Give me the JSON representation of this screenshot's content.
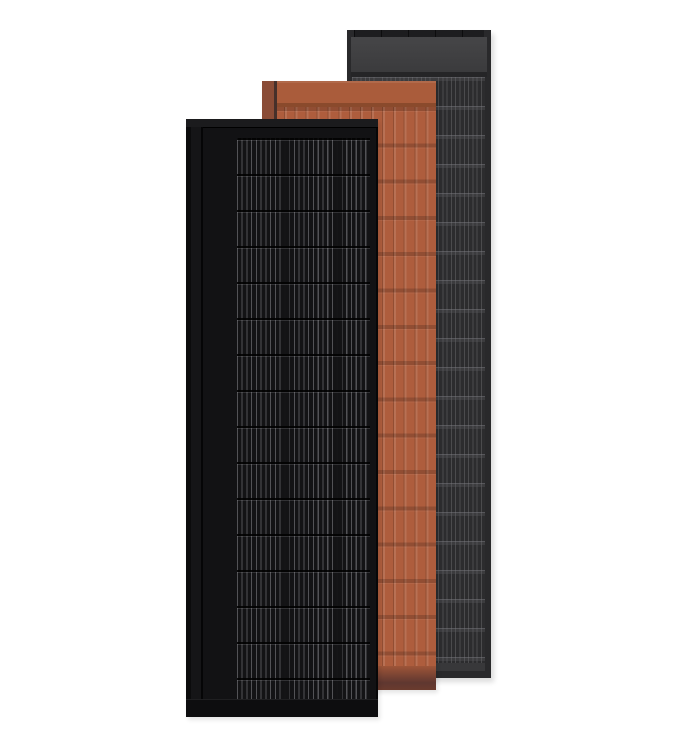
{
  "scene": {
    "description": "Product render of three overlapping rectangular solar roof panels standing upright on a plain white background: a black full-black module in front, a terracotta tile-look module in the middle, and an anthracite dark-gray module at the back.",
    "panel_count": 3
  },
  "panels": [
    {
      "id": "rear-anthracite",
      "label": "Anthracite gray solar panel (rear)",
      "finish": "dark gray with fine vertical cell lines and horizontal cell separators, solid gray header band at top"
    },
    {
      "id": "middle-terracotta",
      "label": "Terracotta solar tile panel (middle)",
      "finish": "orange-brown tile texture with vertical ribs and horizontal course lines, darker shaded footer at bottom"
    },
    {
      "id": "front-black",
      "label": "Black solar panel (front)",
      "finish": "full black module with fine vertical busbar lines grouped into cell columns and horizontal cell separators, black frame"
    }
  ],
  "colors": {
    "background": "#ffffff",
    "gray-frame": "#29292b",
    "gray-toprail": "#1d1d1f",
    "gray-header": "#3e3e40",
    "gray-sep": "#252527",
    "gray-grid-bg": "#2c2c2e",
    "gray-footer": "#38383a",
    "terra-header": "#a85937",
    "terra-left": "#8a4c36",
    "terra-left-line": "#46302a",
    "terra-sep": "#8a4a2c",
    "terra-body": "#ae5d3d",
    "terra-footer-top": "#9e5538",
    "terra-footer-mid": "#5f3730",
    "terra-footer-end": "#6b3b2e",
    "black-body": "#121214",
    "black-toprail": "#1b1b1d",
    "black-leftframe": "#151517",
    "black-grid-bg": "#131315",
    "black-grid-line": "rgba(160,160,166,0.45)",
    "black-bottomrail": "#0d0d0f"
  }
}
